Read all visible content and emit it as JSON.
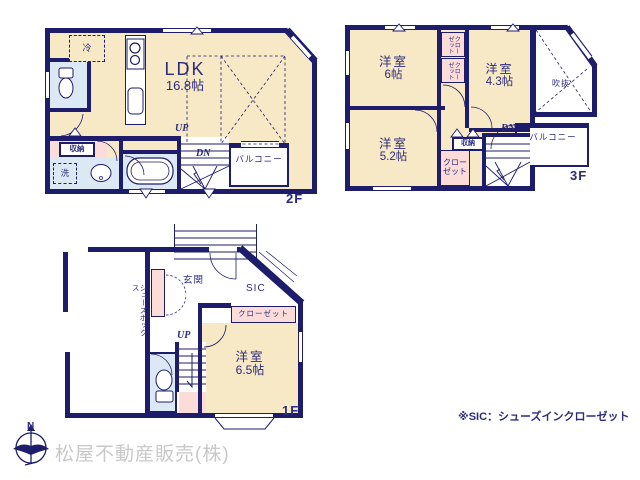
{
  "colors": {
    "wall": "#1e1d6b",
    "room_cream": "#f7e8c6",
    "wet_blue": "#dce8f3",
    "closet_pink": "#fbdcd9",
    "text_navy": "#2c2b7c",
    "company_gray": "#c8c8c8"
  },
  "floor2": {
    "floor_label": "2F",
    "ldk_name": "LDK",
    "ldk_size": "16.8帖",
    "fridge": "冷",
    "storage": "収納",
    "laundry": "洗",
    "up": "UP",
    "down": "DN",
    "balcony": "バルコニー"
  },
  "floor3": {
    "floor_label": "3F",
    "room_6": {
      "name": "洋室",
      "size": "6帖"
    },
    "room_43": {
      "name": "洋室",
      "size": "4.3帖"
    },
    "room_52": {
      "name": "洋室",
      "size": "5.2帖"
    },
    "closet_a": "クローゼット",
    "closet_b": "クローゼット",
    "closet_c": "クローゼット",
    "storage": "収納",
    "void": "吹抜",
    "down": "DN",
    "balcony": "バルコニー"
  },
  "floor1": {
    "floor_label": "1F",
    "entrance": "玄関",
    "sic": "SIC",
    "shoe_box": "シューズボックス",
    "closet": "クローゼット",
    "room_65": {
      "name": "洋室",
      "size": "6.5帖"
    },
    "up": "UP"
  },
  "footer": {
    "compass_north": "N",
    "company": "松屋不動産販売(株)",
    "sic_note": "※SIC：シューズインクローゼット"
  }
}
